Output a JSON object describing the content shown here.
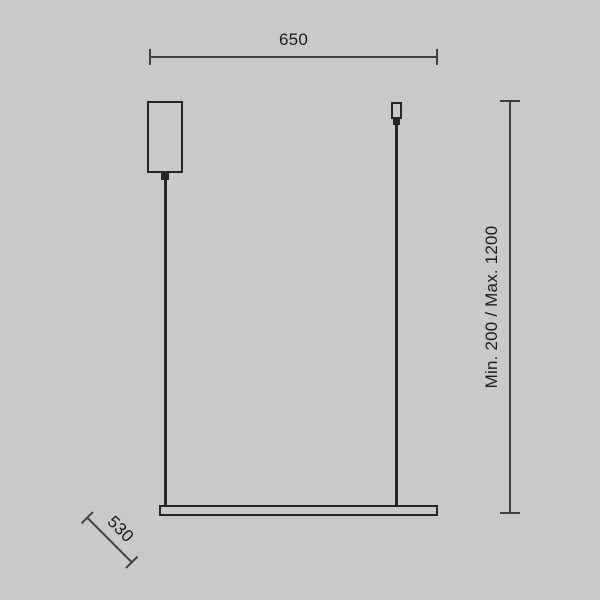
{
  "colors": {
    "background": "#c9c9c9",
    "fixture_line": "#262626",
    "dimension_line": "#3f3f3f",
    "text": "#1c1c1c"
  },
  "dimensions": {
    "width_label": "650",
    "depth_label": "530",
    "height_label": "Min. 200 / Max. 1200"
  }
}
